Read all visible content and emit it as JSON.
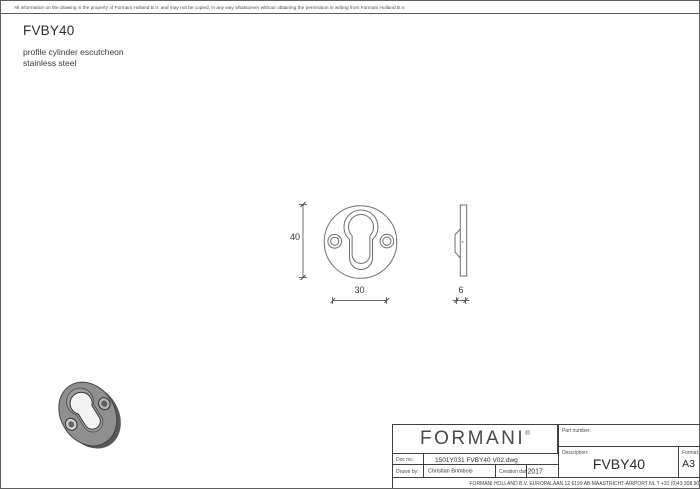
{
  "header": {
    "disclaimer": "All information on the drawing is the property of Formani Holland B.V. and may not be copied, in any way whatsoever without obtaining the permission in writing from Formani Holland B.V.",
    "title": "FVBY40",
    "subtitle_line1": "profile cylinder escutcheon",
    "subtitle_line2": "stainless steel"
  },
  "drawing": {
    "dim_height": "40",
    "dim_width": "30",
    "dim_thickness": "6"
  },
  "title_block": {
    "logo_text": "FORMANI",
    "logo_reg": "®",
    "doc_no_label": "Doc no.:",
    "doc_no_value": "1501Y031 FVBY40 V02.dwg",
    "drawn_by_label": "Drawn by:",
    "drawn_by_value": "Christian Brimbois",
    "creation_date_label": "Creation date:",
    "creation_date_value": "22-8-2017",
    "part_number_label": "Part number:",
    "part_number_value": "",
    "description_label": "Description:",
    "description_value": "FVBY40",
    "format_label": "Format:",
    "format_value": "A3",
    "footer": "FORMANI HOLLAND B.V.  EUROPALAAN 12  6199 AB MAASTRICHT-AIRPORT NL  T +31 (0)43 308 90 00 INFO@FORMANI.COM FORMANI.COM"
  },
  "colors": {
    "drawing_line": "#6e6e6e",
    "dimension_ink": "#3f3f3f",
    "border_ink": "#3f3f3f",
    "render_face": "#8f8f8f",
    "render_side": "#575757"
  }
}
